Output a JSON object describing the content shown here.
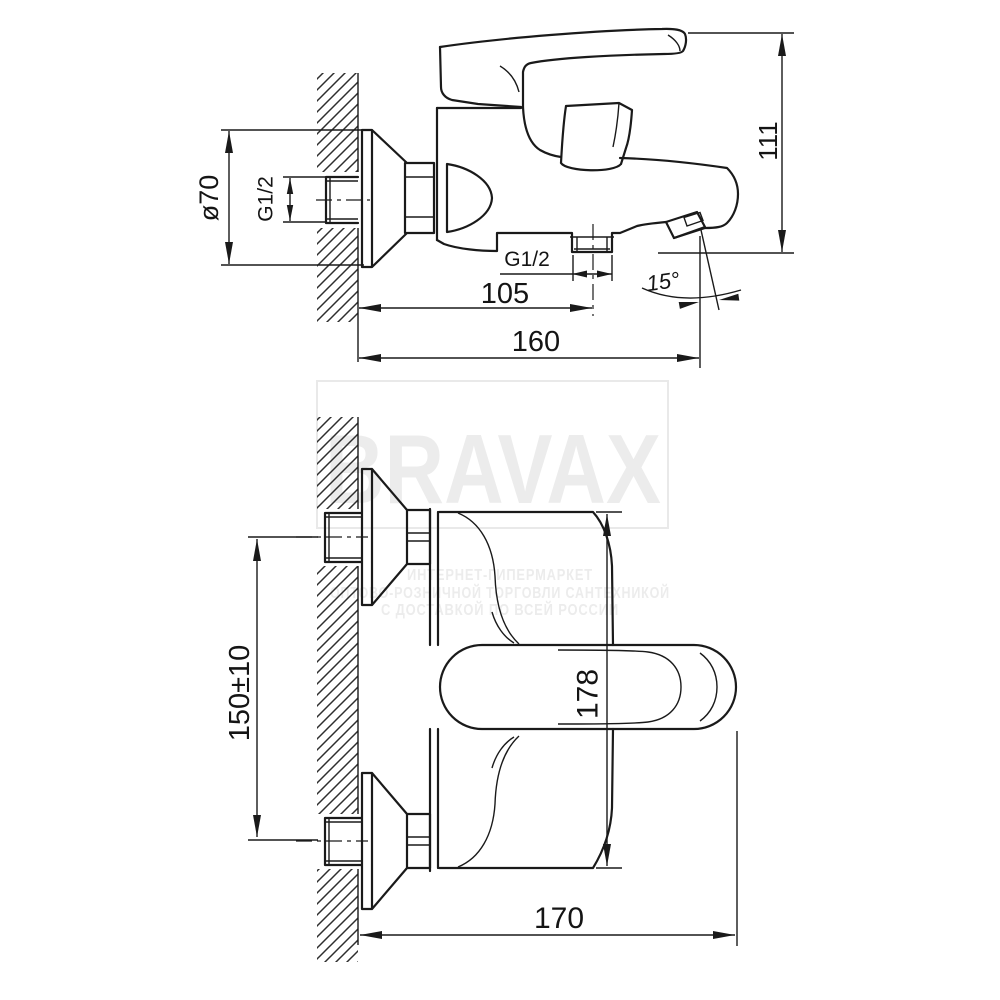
{
  "watermark": {
    "brand": "BRAVAX",
    "tagline_line1": "ИНТЕРНЕТ-ГИПЕРМАРКЕТ",
    "tagline_line2": "ОПТОВО-РОЗНИЧНОЙ ТОРГОВЛИ САНТЕХНИКОЙ",
    "tagline_line3": "С ДОСТАВКОЙ ПО ВСЕЙ РОССИИ",
    "color": "#ececec"
  },
  "side_view": {
    "dim_flange_diameter": "ø70",
    "dim_wall_thread": "G1/2",
    "dim_outlet_thread": "G1/2",
    "dim_wall_to_outlet": "105",
    "dim_wall_to_spout": "160",
    "dim_height": "111",
    "dim_spout_angle": "15°"
  },
  "plan_view": {
    "dim_hole_spacing": "150±10",
    "dim_body_width": "178",
    "dim_total_depth": "170"
  },
  "style": {
    "line_color": "#1a1a1a",
    "background": "#ffffff"
  }
}
